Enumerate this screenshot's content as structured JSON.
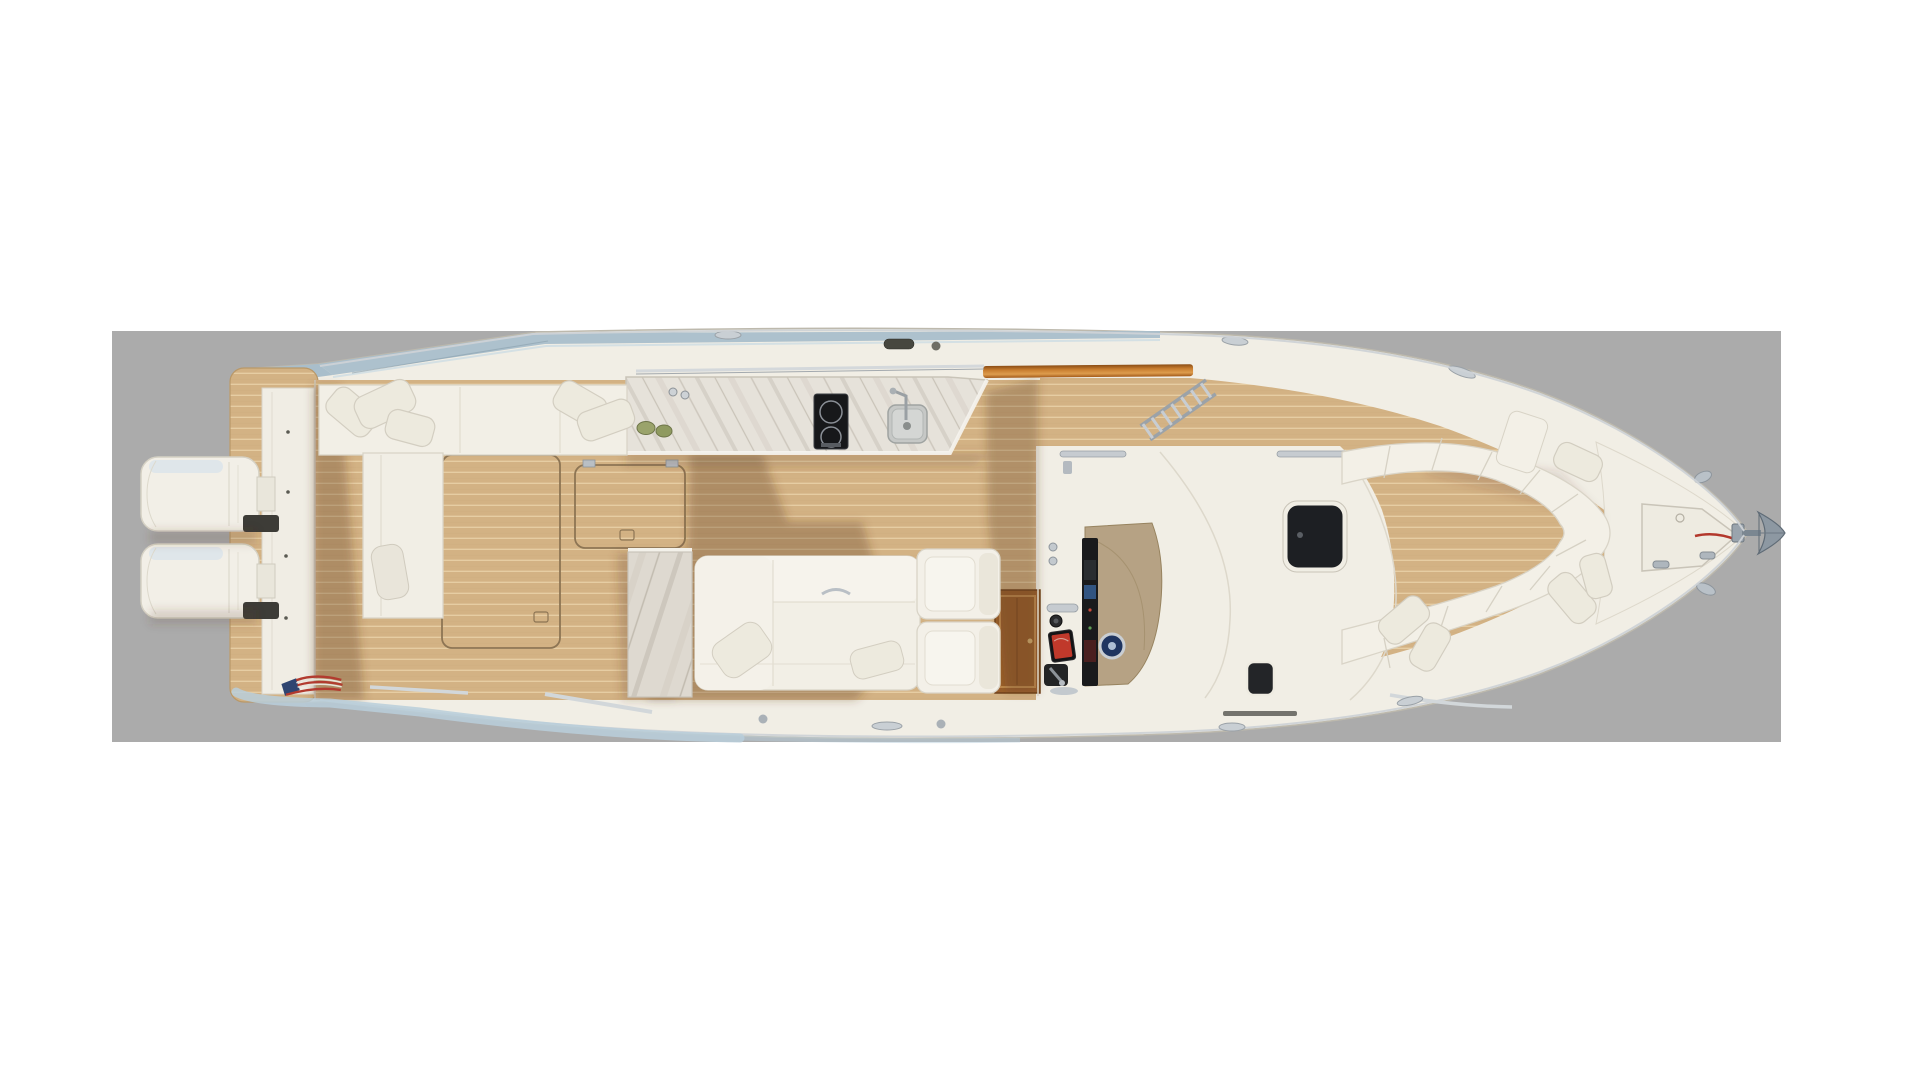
{
  "canvas": {
    "background": "#ffffff",
    "stage_fill": "#ababab",
    "width": 1920,
    "height": 1080
  },
  "labels": {
    "scene": "Overhead deck-plan rendering of a center-console yacht, bow pointing right",
    "stage": "Gray render canvas",
    "boat": "Yacht hull seen from directly above",
    "engines": "Twin outboard engines on the transom",
    "swim_platform": "Teak swim platform",
    "transom": "Transom module",
    "cockpit": "Aft cockpit with teak sole and storage hatches",
    "port_bench": "Port cockpit bench with throw pillows",
    "transom_settee": "Aft-cockpit settee with pillow",
    "deck_hatches": "In-sole storage hatches",
    "galley": "Summer galley: marble counter, two-burner cooktop, sink and faucet",
    "wet_bar": "Marble-faced wet-bar cabinet",
    "lounge": "Cockpit lounge sofa with pillows",
    "companion_seats": "Back-to-back companion seats ahead of the lounge",
    "cabin_door": "Teak companionway door recess",
    "helm": "Helm station with display stack, wheel and throttle",
    "console": "Center console and cabin top with glass skylights",
    "side_ladder": "Stowed boarding ladder on port walkway",
    "bow_seating": "Wraparound bow seating with pillows",
    "foredeck": "Foredeck with anchor-locker hatch and cleats",
    "anchor": "Plow anchor on the bow roller",
    "flag": "American flag decal on the starboard quarter",
    "hardtop_edge": "Blue-tinted hardtop glass edge",
    "waterline": "Ice-blue waterline band"
  },
  "palette": {
    "hull": "#f1eee5",
    "hull_line": "#d9d4c7",
    "teak": "#d3b284",
    "teak_line": "#e6cda3",
    "teak_cap": "#c77c2e",
    "marble": "#e6e2da",
    "marble_vein": "#b8b1a5",
    "shadow": "#5a3c22",
    "glass": "#1d1f23",
    "chrome": "#c9cfd4",
    "accent_blue": "#a9becb",
    "waterline": "#b8cedb",
    "helm_tan": "#b6a284",
    "wheel_navy": "#1f3560",
    "screen_red": "#c0392b",
    "flag_red": "#b23b2f",
    "flag_blue": "#2f4571",
    "anchor_gray": "#8d98a2",
    "wood_door": "#9a5f2c",
    "green_decor": "#9aa36b",
    "dark_fitting": "#47473f"
  },
  "counts": {
    "outboard_engines": 2,
    "cooktop_burners": 2,
    "cockpit_hatches": 2,
    "console_skylights": 2,
    "bow_pillows": 5,
    "cockpit_pillows": 6,
    "companion_seats": 2,
    "foredeck_cleats": 2,
    "helm_screens": 1,
    "anchors": 1
  }
}
